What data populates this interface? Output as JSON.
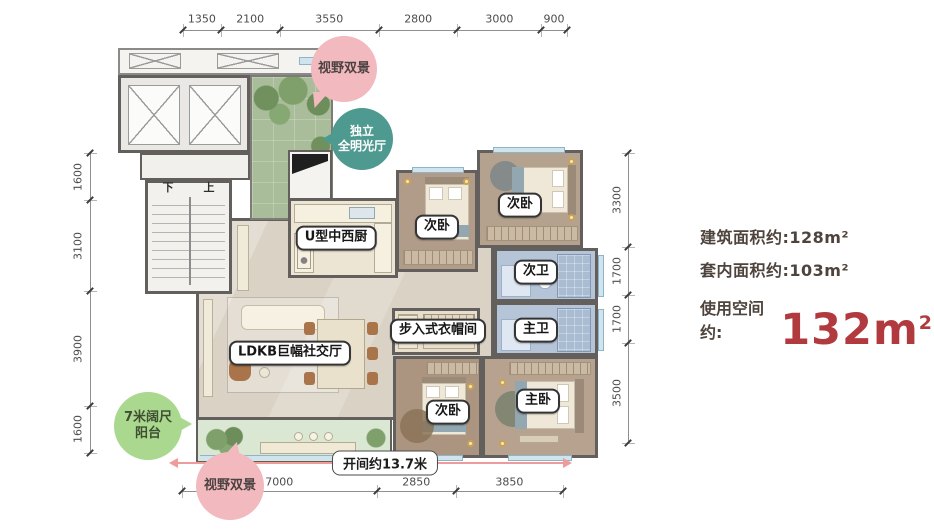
{
  "info": {
    "area_label": "建筑面积约:",
    "area_value": "128m²",
    "inner_label": "套内面积约:",
    "inner_value": "103m²",
    "usage_label": "使用空间约:",
    "usage_value": "132m",
    "usage_sup": "2"
  },
  "dims": {
    "top": [
      "1350",
      "2100",
      "3550",
      "2800",
      "3000",
      "900"
    ],
    "left": [
      "1600",
      "3100",
      "3900",
      "1600"
    ],
    "right": [
      "3300",
      "1700",
      "1700",
      "3500"
    ],
    "bottom": [
      "7000",
      "2850",
      "3850"
    ]
  },
  "span_label": "开间约13.7米",
  "badges": {
    "view_top": "视野双景",
    "bright_hall": [
      "独立",
      "全明光厅"
    ],
    "balcony": [
      "7米阔尺",
      "阳台"
    ],
    "view_bottom": "视野双景"
  },
  "rooms": {
    "kitchen": "U型中西厨",
    "bedroom_top_mid": "次卧",
    "bedroom_top_right": "次卧",
    "bath_second": "次卫",
    "bath_master": "主卫",
    "closet": "步入式衣帽间",
    "living": "LDKB巨幅社交厅",
    "bedroom_bottom": "次卧",
    "bedroom_master": "主卧"
  },
  "stairs": {
    "down": "下",
    "up": "上"
  },
  "colors": {
    "accent_red": "#b13a3f",
    "span_red": "#ef9b9b",
    "badge_pink": "#f2b9be",
    "badge_teal": "#4f9a90",
    "badge_green": "#a9d88e",
    "wall": "#625f5c"
  }
}
